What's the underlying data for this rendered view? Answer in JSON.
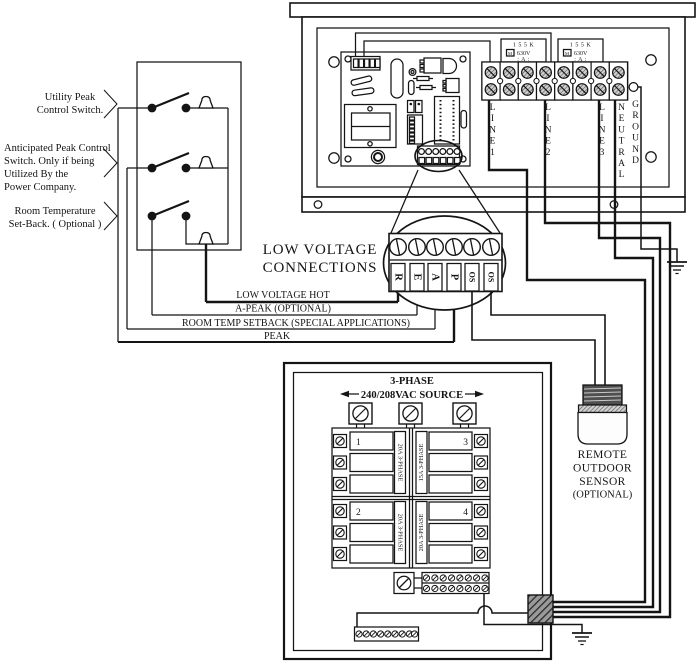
{
  "diagram": {
    "switch_box": {
      "labels": {
        "utility": [
          "Utility Peak",
          "Control Switch."
        ],
        "anticipated": [
          "Anticipated Peak Control",
          "Switch. Only if being",
          "Utilized By the",
          "Power Company."
        ],
        "room": [
          "Room Temperature",
          "Set-Back. ( Optional )"
        ]
      }
    },
    "control_panel": {
      "fuses": {
        "rating_top": "1 5 5 K",
        "symbol": "M",
        "rating_mid": "630V",
        "rating_bottom": ": A :"
      },
      "terminals": [
        "LINE1",
        "LINE2",
        "LINE3",
        "NEUTRAL",
        "GROUND"
      ]
    },
    "low_voltage": {
      "heading_line1": "LOW VOLTAGE",
      "heading_line2": "CONNECTIONS",
      "terminals": [
        "R",
        "E",
        "A",
        "P",
        "OS",
        "OS"
      ],
      "wires": {
        "hot": "LOW VOLTAGE HOT",
        "a_peak": "A-PEAK (OPTIONAL)",
        "room_temp": "ROOM TEMP SETBACK (SPECIAL APPLICATIONS)",
        "peak": "PEAK"
      }
    },
    "breaker_panel": {
      "title_line1": "3-PHASE",
      "title_line2": "240/208VAC SOURCE",
      "breaker1": {
        "number": "1",
        "rating": "20A 3-PHASE"
      },
      "breaker2": {
        "number": "2",
        "rating": "20A 3-PHASE"
      },
      "breaker3": {
        "number": "3",
        "rating": "15A 3-PHASE"
      },
      "breaker4": {
        "number": "4",
        "rating": "20A 3-PHASE"
      }
    },
    "sensor": {
      "label": [
        "REMOTE",
        "OUTDOOR",
        "SENSOR",
        "(OPTIONAL)"
      ]
    }
  }
}
